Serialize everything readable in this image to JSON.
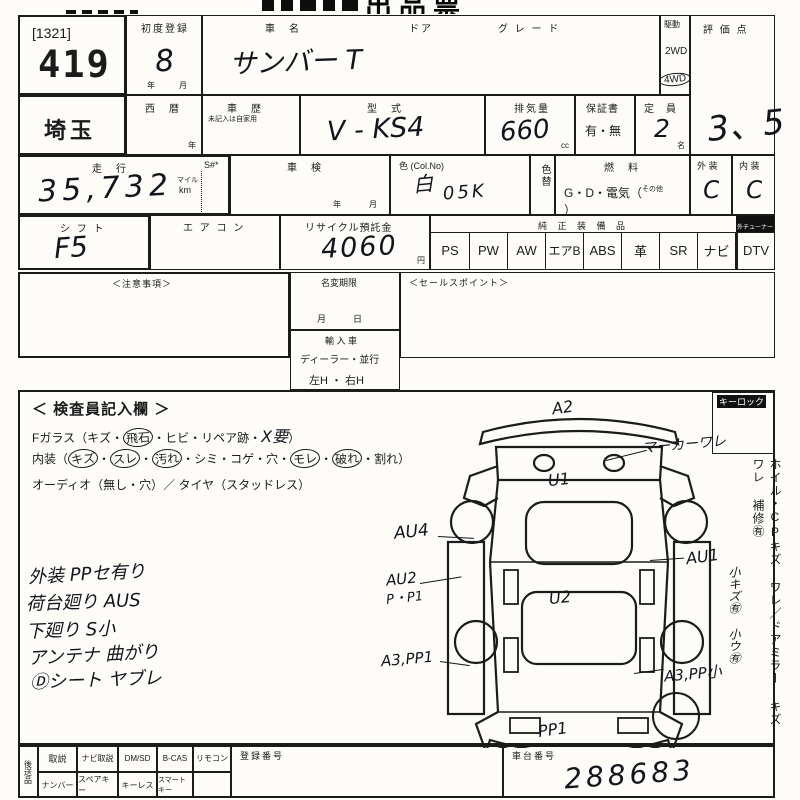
{
  "title": "出品票",
  "header": {
    "corner_tag": "[1321]",
    "lot_number": "419",
    "first_reg_label": "初度登録",
    "first_reg_value": "8",
    "first_reg_unit": "年　月",
    "car_name_label": "車　名",
    "car_name_value": "サンバー T",
    "door_label": "ドア",
    "grade_label": "グ レ ー ド",
    "drive_label": "駆動",
    "drive_2wd": "2WD",
    "drive_4wd": "4WD",
    "score_label": "評 価 点",
    "score_value": "3、5"
  },
  "row2": {
    "prefecture": "埼玉",
    "seireki_label": "西　暦",
    "year_unit": "年",
    "history_label": "車　歴",
    "history_note": "未記入は自家用",
    "model_label": "型　式",
    "model_value": "V - KS4",
    "displacement_label": "排気量",
    "displacement_value": "660",
    "displacement_unit": "cc",
    "warranty_label": "保証書",
    "warranty_value": "有・無",
    "capacity_label": "定　員",
    "capacity_value": "2",
    "capacity_unit": "名"
  },
  "row3": {
    "mileage_label": "走　行",
    "mileage_value": "35,732",
    "unit_mile": "マイル",
    "unit_km": "km",
    "s_label": "S#*",
    "inspection_label": "車　検",
    "inspection_unit": "年　　月",
    "color_label": "色 (Col.No)",
    "color_value": "白",
    "color_no": "05K",
    "color_change_label": "色替",
    "fuel_label": "燃　料",
    "fuel_pre": "G・D・電気（",
    "fuel_small": "その他",
    "fuel_post": "）",
    "exterior_label": "外 装",
    "exterior_value": "C",
    "interior_label": "内 装",
    "interior_value": "C"
  },
  "row4": {
    "shift_label": "シ フ ト",
    "shift_value": "F5",
    "aircon_label": "エ ア コ ン",
    "recycle_label": "リサイクル預託金",
    "recycle_value": "4060",
    "recycle_unit": "円",
    "equipment_header": "純 正 装 備 品",
    "tuner_note": "外チューナー無",
    "equipment": [
      "PS",
      "PW",
      "AW",
      "エアB",
      "ABS",
      "革",
      "SR",
      "ナビ"
    ],
    "dtv_label": "DTV"
  },
  "row5": {
    "notes_label": "＜注意事項＞",
    "name_change_label": "名変期限",
    "name_change_unit": "月　　　日",
    "import_label": "輸 入 車",
    "import_type": "ディーラー・並行",
    "import_handle": "左H ・ 右H",
    "sales_label": "＜セールスポイント＞"
  },
  "inspector": {
    "title": "＜ 検査員記入欄 ＞",
    "glass_prefix": "Fガラス（キズ・",
    "glass_circled": "飛石",
    "glass_mid": "・ヒビ・リペア跡・",
    "glass_hand": "X要",
    "glass_suffix": "）",
    "interior_prefix": "内装（",
    "interior_c1": "キズ",
    "interior_d1": "・",
    "interior_c2": "スレ",
    "interior_d2": "・",
    "interior_c3": "汚れ",
    "interior_mid": "・シミ・コゲ・穴・",
    "interior_c4": "モレ",
    "interior_d3": "・",
    "interior_c5": "破れ",
    "interior_suffix": "・割れ）",
    "audio_line": "オーディオ（無し・穴）／ タイヤ（スタッドレス）"
  },
  "hand_notes": [
    "外装 PPセ有り",
    "荷台廻り AUS",
    "下廻り S小",
    "アンテナ 曲がり",
    "Ⓓシート ヤブレ"
  ],
  "diagram": {
    "front": "A2",
    "marker": "マーカーワレ",
    "u1": "U1",
    "au4": "AU4",
    "au1": "AU1",
    "au2": "AU2",
    "au2_sub": "P・P1",
    "u2": "U2",
    "a3_left": "A3,PP1",
    "a3_right": "A3,PP小",
    "rear": "PP1"
  },
  "right_panel": {
    "keylock": "キーロック",
    "printed": "ホイル・CPキズ ワレ／ドアミラー キズ ワレ 補修㊒",
    "hand": "小キズ㊒ 小ウ㊒"
  },
  "bottom": {
    "side_label": "後送品",
    "row1": [
      "取説",
      "ナビ取説",
      "DM/SD",
      "B-CAS",
      "リモコン"
    ],
    "row2": [
      "ナンバー",
      "スペアキー",
      "キーレス",
      "スマートキー"
    ],
    "reg_label": "登録番号",
    "chassis_label": "車台番号",
    "chassis_value": "288683"
  }
}
